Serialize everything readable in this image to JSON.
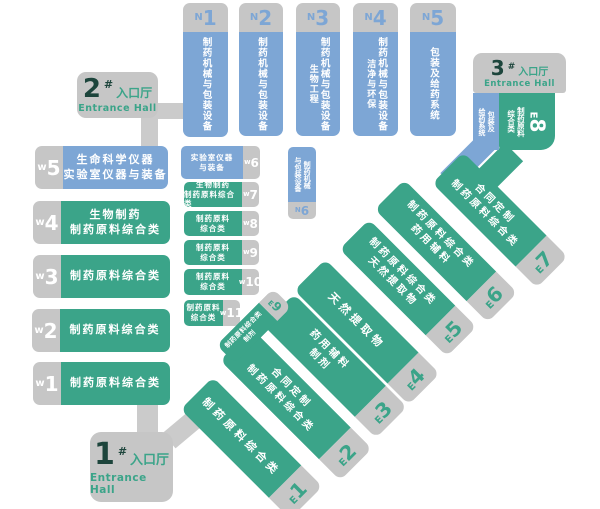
{
  "colors": {
    "hall_blue": "#7DA6D5",
    "hall_green": "#3BA489",
    "label_gray": "#C6C6C6",
    "corridor_gray": "#CBCBCB",
    "dark_number": "#1D453C"
  },
  "entrances": {
    "e1": {
      "number": "1",
      "hash": "#",
      "name_cn": "入口厅",
      "name_en": "Entrance Hall"
    },
    "e2": {
      "number": "2",
      "hash": "#",
      "name_cn": "入口厅",
      "name_en": "Entrance Hall"
    },
    "e3": {
      "number": "3",
      "hash": "#",
      "name_cn": "入口厅",
      "name_en": "Entrance Hall"
    }
  },
  "halls": {
    "n1": {
      "letter": "N",
      "num": "1",
      "line1": "制药机械与包装设备"
    },
    "n2": {
      "letter": "N",
      "num": "2",
      "line1": "制药机械与包装设备"
    },
    "n3": {
      "letter": "N",
      "num": "3",
      "line1": "制药机械与包装设备",
      "line2": "生物工程"
    },
    "n4": {
      "letter": "N",
      "num": "4",
      "line1": "制药机械与包装设备",
      "line2": "洁净与环保"
    },
    "n5": {
      "letter": "N",
      "num": "5",
      "line1": "包装及给药系统"
    },
    "n6": {
      "letter": "N",
      "num": "6",
      "line1": "制药机械",
      "line2": "与包装设备"
    },
    "w1": {
      "letter": "w",
      "num": "1",
      "line1": "制药原料综合类"
    },
    "w2": {
      "letter": "w",
      "num": "2",
      "line1": "制药原料综合类"
    },
    "w3": {
      "letter": "w",
      "num": "3",
      "line1": "制药原料综合类"
    },
    "w4": {
      "letter": "w",
      "num": "4",
      "line1": "生物制药",
      "line2": "制药原料综合类"
    },
    "w5": {
      "letter": "w",
      "num": "5",
      "line1": "生命科学仪器",
      "line2": "实验室仪器与装备"
    },
    "w6": {
      "letter": "w",
      "num": "6",
      "line1": "实验室仪器",
      "line2": "与装备"
    },
    "w7": {
      "letter": "w",
      "num": "7",
      "line1": "生物制药",
      "line2": "制药原料综合类"
    },
    "w8": {
      "letter": "w",
      "num": "8",
      "line1": "制药原料",
      "line2": "综合类"
    },
    "w9": {
      "letter": "w",
      "num": "9",
      "line1": "制药原料",
      "line2": "综合类"
    },
    "w10": {
      "letter": "w",
      "num": "10",
      "line1": "制药原料",
      "line2": "综合类"
    },
    "w11": {
      "letter": "w",
      "num": "11",
      "line1": "制药原料",
      "line2": "综合类"
    },
    "e1h": {
      "letter": "E",
      "num": "1",
      "line1": "制药原料综合类"
    },
    "e2h": {
      "letter": "E",
      "num": "2",
      "line1": "合同定制",
      "line2": "制药原料综合类"
    },
    "e3h": {
      "letter": "E",
      "num": "3",
      "line1": "药用辅料",
      "line2": "制剂"
    },
    "e4h": {
      "letter": "E",
      "num": "4",
      "line1": "天然提取物"
    },
    "e5h": {
      "letter": "E",
      "num": "5",
      "line1": "制药原料综合类",
      "line2": "天然提取物"
    },
    "e6h": {
      "letter": "E",
      "num": "6",
      "line1": "制药原料综合类",
      "line2": "药用辅料"
    },
    "e7h": {
      "letter": "E",
      "num": "7",
      "line1": "合同定制",
      "line2": "制药原料综合类"
    },
    "e8h": {
      "letter": "E",
      "num": "8",
      "green_line1": "制药原料",
      "green_line2": "综合类",
      "blue_line1": "包装及",
      "blue_line2": "给药系统"
    },
    "e9h": {
      "letter": "E",
      "num": "9",
      "line1": "制药原料综合类",
      "line2": "制剂"
    }
  }
}
